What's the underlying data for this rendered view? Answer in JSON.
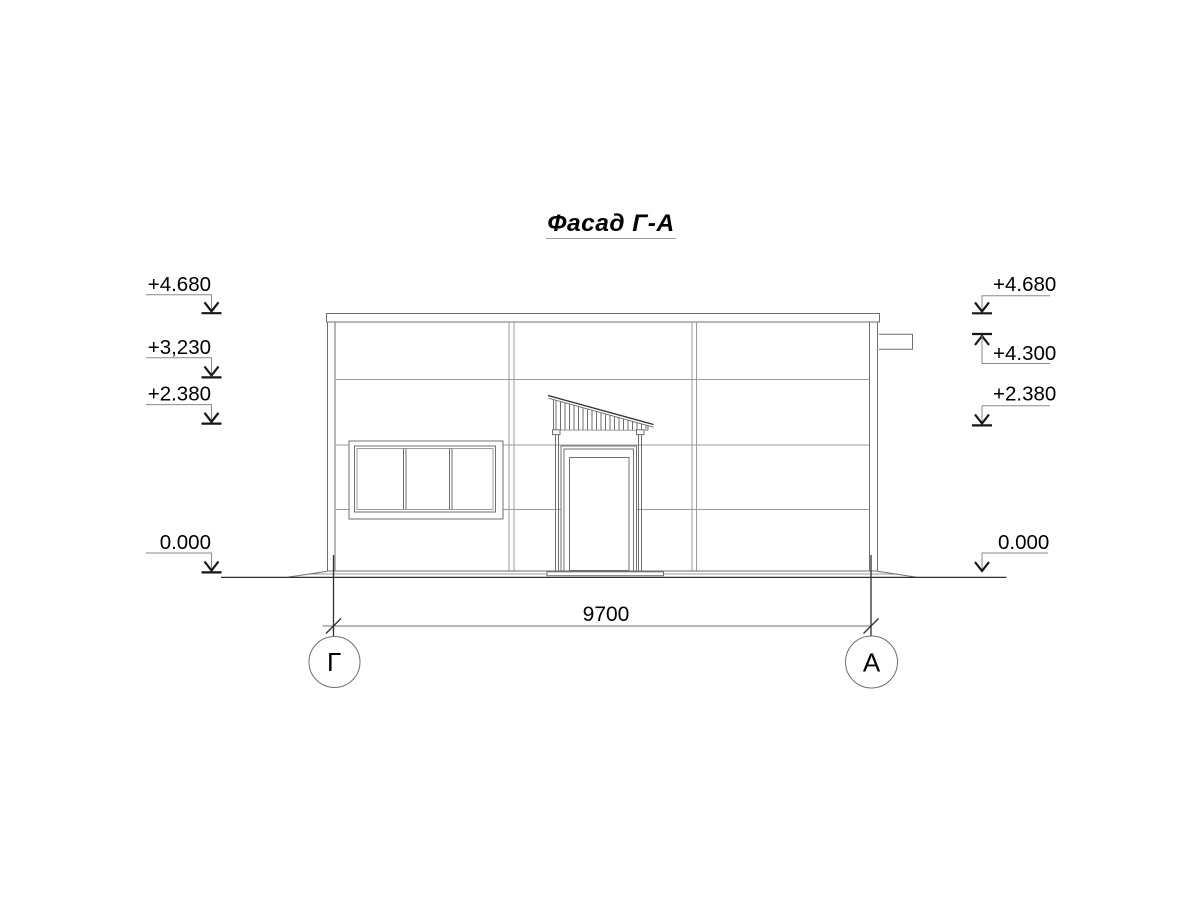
{
  "drawing": {
    "title": "Фасад Г-А"
  },
  "elevation_marks": {
    "left": [
      {
        "label": "+4.680"
      },
      {
        "label": "+3,230"
      },
      {
        "label": "+2.380"
      },
      {
        "label": "0.000"
      }
    ],
    "right": [
      {
        "label": "+4.680"
      },
      {
        "label": "+4.300"
      },
      {
        "label": "+2.380"
      },
      {
        "label": "0.000"
      }
    ]
  },
  "dimension": {
    "overall_width": "9700"
  },
  "axes": {
    "left_label": "Г",
    "right_label": "А"
  },
  "colors": {
    "paper": "#ffffff",
    "line_dark": "#2f2f2f",
    "line_main": "#6f6f6f",
    "line_light": "#9c9c9c",
    "text": "#000000"
  }
}
